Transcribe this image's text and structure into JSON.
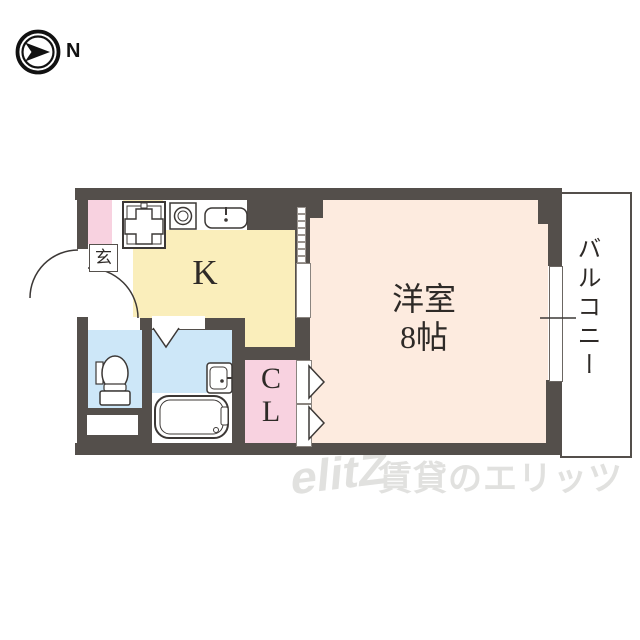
{
  "compass": {
    "label": "N"
  },
  "plan": {
    "entrance": {
      "label": "玄"
    },
    "kitchen": {
      "label": "K"
    },
    "western_room": {
      "label": "洋室\n8帖"
    },
    "closet": {
      "label": "C\nL"
    },
    "balcony": {
      "label": "バルコニー"
    }
  },
  "watermark": {
    "logo": "elitZ",
    "text": "賃貸のエリッツ"
  },
  "colors": {
    "wall": "#544f4b",
    "kitchen": "#faeebb",
    "room": "#fdebdf",
    "pink": "#f8d2e0",
    "water": "#cde7f8",
    "line": "#3c3836",
    "text": "#2e2a27",
    "watermark": "#e1e1df"
  }
}
